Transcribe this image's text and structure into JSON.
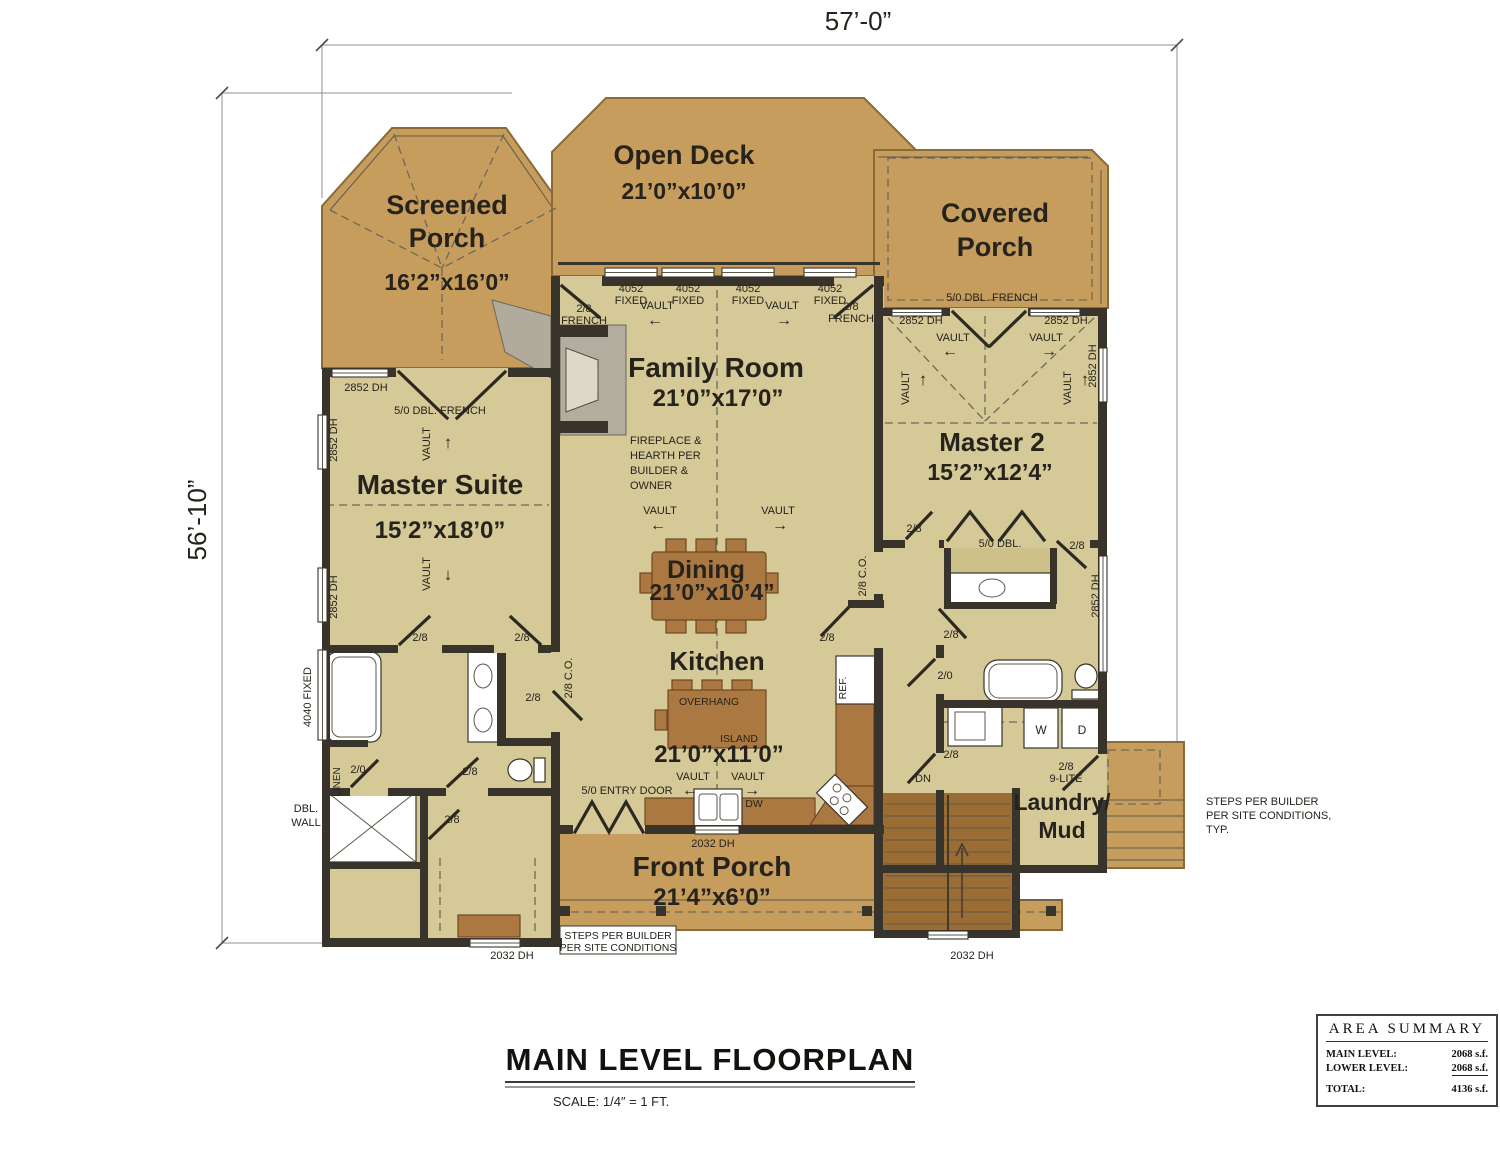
{
  "colors": {
    "floor": "#d5c997",
    "deck": "#c79d5e",
    "wood": "#aa7840",
    "wall": "#38342c",
    "accent_gray": "#b0ab9c"
  },
  "dimensions": {
    "top": "57’-0”",
    "left": "56’-10”"
  },
  "title_block": {
    "title": "MAIN LEVEL FLOORPLAN",
    "scale": "SCALE: 1/4″ = 1 FT."
  },
  "area_summary": {
    "title": "AREA SUMMARY",
    "rows": [
      {
        "label": "MAIN LEVEL:",
        "value": "2068 s.f."
      },
      {
        "label": "LOWER LEVEL:",
        "value": "2068 s.f."
      }
    ],
    "total": {
      "label": "TOTAL:",
      "value": "4136 s.f."
    }
  },
  "annotations": [
    {
      "n": "dim-top",
      "t": "57’-0”",
      "x": 858,
      "y": 30,
      "s": 26,
      "c": "#4c4c4c"
    },
    {
      "n": "dim-left",
      "t": "56’-10”",
      "x": 206,
      "y": 520,
      "s": 26,
      "r": -90,
      "c": "#4c4c4c"
    },
    {
      "n": "room-screened-porch",
      "t": "Screened\nPorch",
      "x": 447,
      "y": 214,
      "s": 27,
      "b": 1,
      "lh": 33
    },
    {
      "n": "room-screened-porch-dims",
      "t": "16’2”x16’0”",
      "x": 447,
      "y": 290,
      "s": 23,
      "b": 1
    },
    {
      "n": "room-open-deck",
      "t": "Open Deck",
      "x": 684,
      "y": 164,
      "s": 27,
      "b": 1
    },
    {
      "n": "room-open-deck-dims",
      "t": "21’0”x10’0”",
      "x": 684,
      "y": 199,
      "s": 23,
      "b": 1
    },
    {
      "n": "room-covered-porch",
      "t": "Covered\nPorch",
      "x": 995,
      "y": 222,
      "s": 27,
      "b": 1,
      "lh": 34
    },
    {
      "n": "room-family",
      "t": "Family Room",
      "x": 716,
      "y": 377,
      "s": 28,
      "b": 1
    },
    {
      "n": "room-family-dims",
      "t": "21’0”x17’0”",
      "x": 718,
      "y": 406,
      "s": 24,
      "b": 1
    },
    {
      "n": "room-master-suite",
      "t": "Master Suite",
      "x": 440,
      "y": 494,
      "s": 28,
      "b": 1
    },
    {
      "n": "room-master-suite-dims",
      "t": "15’2”x18’0”",
      "x": 440,
      "y": 538,
      "s": 24,
      "b": 1
    },
    {
      "n": "room-master2",
      "t": "Master 2",
      "x": 992,
      "y": 451,
      "s": 26,
      "b": 1
    },
    {
      "n": "room-master2-dims",
      "t": "15’2”x12’4”",
      "x": 990,
      "y": 480,
      "s": 23,
      "b": 1
    },
    {
      "n": "room-dining",
      "t": "Dining",
      "x": 706,
      "y": 578,
      "s": 25,
      "b": 1
    },
    {
      "n": "room-dining-dims",
      "t": "21’0”x10’4”",
      "x": 712,
      "y": 600,
      "s": 23,
      "b": 1
    },
    {
      "n": "room-kitchen",
      "t": "Kitchen",
      "x": 717,
      "y": 670,
      "s": 26,
      "b": 1
    },
    {
      "n": "room-kitchen-dims",
      "t": "21’0”x11’0”",
      "x": 719,
      "y": 762,
      "s": 24,
      "b": 1
    },
    {
      "n": "room-laundry",
      "t": "Laundry/\nMud",
      "x": 1062,
      "y": 810,
      "s": 23,
      "b": 1,
      "lh": 28
    },
    {
      "n": "room-front-porch",
      "t": "Front Porch",
      "x": 712,
      "y": 876,
      "s": 28,
      "b": 1
    },
    {
      "n": "room-front-porch-dims",
      "t": "21’4”x6’0”",
      "x": 712,
      "y": 905,
      "s": 24,
      "b": 1
    },
    {
      "n": "label-window-4052-1",
      "t": "4052\nFIXED",
      "x": 631,
      "y": 292
    },
    {
      "n": "label-window-4052-2",
      "t": "4052\nFIXED",
      "x": 688,
      "y": 292
    },
    {
      "n": "label-window-4052-3",
      "t": "4052\nFIXED",
      "x": 748,
      "y": 292
    },
    {
      "n": "label-window-4052-4",
      "t": "4052\nFIXED",
      "x": 830,
      "y": 292
    },
    {
      "n": "label-door-28french-left",
      "t": "2/8\nFRENCH",
      "x": 584,
      "y": 312
    },
    {
      "n": "label-door-28french-right",
      "t": "2/8\nFRENCH",
      "x": 851,
      "y": 310
    },
    {
      "n": "label-vault-fam-nw",
      "t": "VAULT",
      "x": 657,
      "y": 309
    },
    {
      "n": "arrow-vault-fam-nw",
      "t": "←",
      "x": 655,
      "y": 325,
      "s": 16
    },
    {
      "n": "label-vault-fam-ne",
      "t": "VAULT",
      "x": 782,
      "y": 309
    },
    {
      "n": "arrow-vault-fam-ne",
      "t": "→",
      "x": 784,
      "y": 325,
      "s": 16
    },
    {
      "n": "label-vault-fam-sw",
      "t": "VAULT",
      "x": 660,
      "y": 514
    },
    {
      "n": "arrow-vault-fam-sw",
      "t": "←",
      "x": 658,
      "y": 530,
      "s": 16
    },
    {
      "n": "label-vault-fam-se",
      "t": "VAULT",
      "x": 778,
      "y": 514
    },
    {
      "n": "arrow-vault-fam-se",
      "t": "→",
      "x": 780,
      "y": 530,
      "s": 16
    },
    {
      "n": "label-vault-kitchen-w",
      "t": "VAULT",
      "x": 693,
      "y": 780
    },
    {
      "n": "arrow-vault-kitchen-w",
      "t": "←",
      "x": 690,
      "y": 795,
      "s": 16
    },
    {
      "n": "label-vault-kitchen-e",
      "t": "VAULT",
      "x": 748,
      "y": 780
    },
    {
      "n": "arrow-vault-kitchen-e",
      "t": "→",
      "x": 752,
      "y": 795,
      "s": 16
    },
    {
      "n": "label-vault-ms-n",
      "t": "VAULT",
      "x": 430,
      "y": 444,
      "r": -90
    },
    {
      "n": "arrow-vault-ms-n",
      "t": "↑",
      "x": 448,
      "y": 448,
      "s": 17
    },
    {
      "n": "label-vault-ms-s",
      "t": "VAULT",
      "x": 430,
      "y": 574,
      "r": -90
    },
    {
      "n": "arrow-vault-ms-s",
      "t": "↓",
      "x": 448,
      "y": 580,
      "s": 17
    },
    {
      "n": "label-vault-m2-w",
      "t": "VAULT",
      "x": 953,
      "y": 341
    },
    {
      "n": "arrow-vault-m2-w",
      "t": "←",
      "x": 950,
      "y": 356,
      "s": 16
    },
    {
      "n": "label-vault-m2-e",
      "t": "VAULT",
      "x": 1046,
      "y": 341
    },
    {
      "n": "arrow-vault-m2-e",
      "t": "→",
      "x": 1049,
      "y": 356,
      "s": 16
    },
    {
      "n": "label-vault-m2-sw",
      "t": "VAULT",
      "x": 909,
      "y": 388,
      "r": -90
    },
    {
      "n": "arrow-vault-m2-sw",
      "t": "↑",
      "x": 923,
      "y": 385,
      "s": 17
    },
    {
      "n": "label-vault-m2-se",
      "t": "VAULT",
      "x": 1071,
      "y": 388,
      "r": -90
    },
    {
      "n": "arrow-vault-m2-se",
      "t": "↑",
      "x": 1085,
      "y": 385,
      "s": 17
    },
    {
      "n": "label-window-2852-ms",
      "t": "2852 DH",
      "x": 366,
      "y": 391
    },
    {
      "n": "label-door-50dbl-ms",
      "t": "5/0 DBL. FRENCH",
      "x": 440,
      "y": 414
    },
    {
      "n": "label-window-2852-w1",
      "t": "2852 DH",
      "x": 337,
      "y": 440,
      "r": -90
    },
    {
      "n": "label-window-2852-w2",
      "t": "2852 DH",
      "x": 337,
      "y": 597,
      "r": -90
    },
    {
      "n": "label-window-4040",
      "t": "4040 FIXED",
      "x": 311,
      "y": 697,
      "r": -90
    },
    {
      "n": "label-door-50dbl-cp",
      "t": "5/0 DBL. FRENCH",
      "x": 992,
      "y": 301
    },
    {
      "n": "label-window-2852-cp1",
      "t": "2852 DH",
      "x": 921,
      "y": 324
    },
    {
      "n": "label-window-2852-cp2",
      "t": "2852 DH",
      "x": 1066,
      "y": 324
    },
    {
      "n": "label-window-2852-e1",
      "t": "2852 DH",
      "x": 1096,
      "y": 366,
      "r": -90
    },
    {
      "n": "label-window-2852-e2",
      "t": "2852 DH",
      "x": 1099,
      "y": 596,
      "r": -90
    },
    {
      "n": "note-fireplace",
      "t": "FIREPLACE &\nHEARTH PER\nBUILDER &\nOWNER",
      "x": 630,
      "y": 444,
      "a": "s",
      "lh": 15
    },
    {
      "n": "label-co-west",
      "t": "2/8 C.O.",
      "x": 572,
      "y": 678,
      "r": -90
    },
    {
      "n": "label-co-east",
      "t": "2/8 C.O.",
      "x": 866,
      "y": 576,
      "r": -90
    },
    {
      "n": "label-door-28-ms1",
      "t": "2/8",
      "x": 420,
      "y": 641
    },
    {
      "n": "label-door-28-ms2",
      "t": "2/8",
      "x": 522,
      "y": 641
    },
    {
      "n": "label-door-28-hall-w",
      "t": "2/8",
      "x": 533,
      "y": 701
    },
    {
      "n": "label-door-28-wc",
      "t": "2/8",
      "x": 470,
      "y": 775
    },
    {
      "n": "label-door-20-linen",
      "t": "2/0",
      "x": 358,
      "y": 773
    },
    {
      "n": "label-linen",
      "t": "LINEN",
      "x": 340,
      "y": 782,
      "r": -90,
      "s": 10
    },
    {
      "n": "label-door-28-shower",
      "t": "2/8",
      "x": 452,
      "y": 823
    },
    {
      "n": "note-dbl-wall",
      "t": "DBL.\nWALL",
      "x": 306,
      "y": 812,
      "lh": 14
    },
    {
      "n": "label-door-28-ref",
      "t": "2/8",
      "x": 827,
      "y": 641
    },
    {
      "n": "label-ref",
      "t": "REF.",
      "x": 846,
      "y": 688,
      "r": -90,
      "s": 10.5
    },
    {
      "n": "label-door-28-hall-e",
      "t": "2/8",
      "x": 951,
      "y": 638
    },
    {
      "n": "label-door-20-bath",
      "t": "2/0",
      "x": 945,
      "y": 679
    },
    {
      "n": "label-door-28-laundry",
      "t": "2/8",
      "x": 951,
      "y": 758
    },
    {
      "n": "label-dn",
      "t": "DN",
      "x": 923,
      "y": 782
    },
    {
      "n": "label-door-28-m2w",
      "t": "2/8",
      "x": 914,
      "y": 532
    },
    {
      "n": "label-door-50dbl-m2",
      "t": "5/0 DBL.",
      "x": 1000,
      "y": 547
    },
    {
      "n": "label-door-28-m2e",
      "t": "2/8",
      "x": 1077,
      "y": 549
    },
    {
      "n": "label-washer",
      "t": "W",
      "x": 1041,
      "y": 734,
      "s": 12
    },
    {
      "n": "label-dryer",
      "t": "D",
      "x": 1082,
      "y": 734,
      "s": 12
    },
    {
      "n": "label-door-28-9lite",
      "t": "2/8\n9-LITE",
      "x": 1066,
      "y": 770,
      "lh": 12
    },
    {
      "n": "label-entry-door",
      "t": "5/0 ENTRY DOOR",
      "x": 627,
      "y": 794
    },
    {
      "n": "label-window-2032-kitchen",
      "t": "2032 DH",
      "x": 713,
      "y": 847
    },
    {
      "n": "label-dw",
      "t": "DW",
      "x": 754,
      "y": 807,
      "s": 10.5
    },
    {
      "n": "note-steps-porch",
      "t": "STEPS PER BUILDER\nPER SITE CONDITIONS",
      "x": 618,
      "y": 939,
      "s": 10.5,
      "lh": 12
    },
    {
      "n": "label-window-2032-sw",
      "t": "2032 DH",
      "x": 512,
      "y": 959
    },
    {
      "n": "label-window-2032-stairs",
      "t": "2032 DH",
      "x": 972,
      "y": 959
    },
    {
      "n": "note-steps-side",
      "t": "STEPS PER BUILDER\nPER SITE CONDITIONS,\nTYP.",
      "x": 1206,
      "y": 805,
      "a": "s",
      "lh": 14
    },
    {
      "n": "label-island",
      "t": "ISLAND",
      "x": 758,
      "y": 742,
      "a": "e",
      "s": 10.5
    },
    {
      "n": "label-overhang",
      "t": "OVERHANG",
      "x": 679,
      "y": 705,
      "a": "s",
      "s": 10.5
    }
  ]
}
